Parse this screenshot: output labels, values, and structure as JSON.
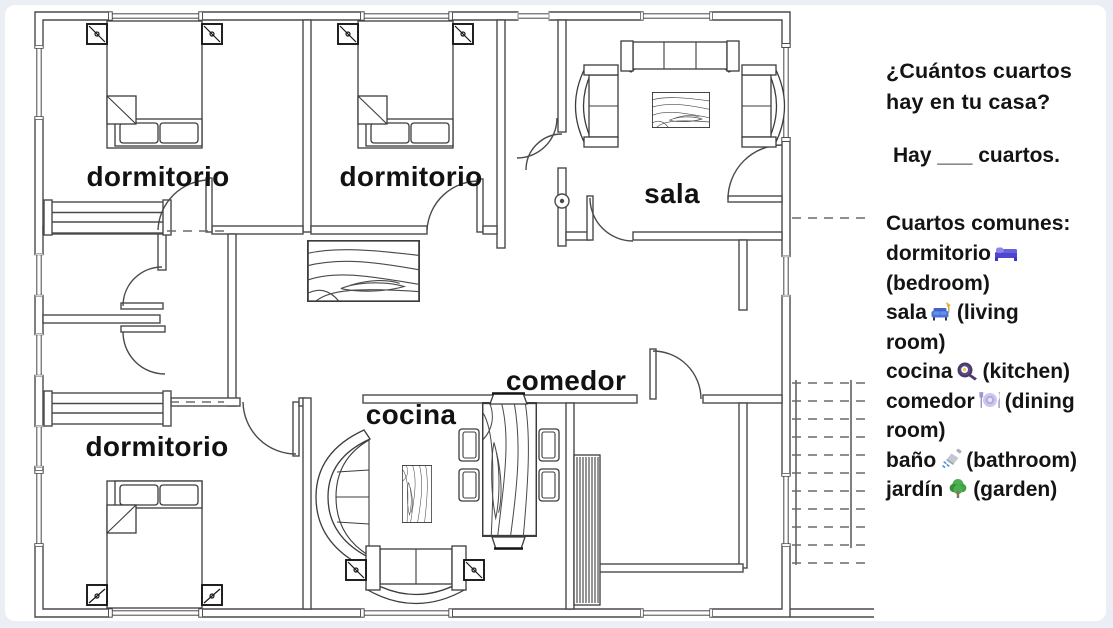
{
  "colors": {
    "wall": "#4a4a4a",
    "text": "#141414",
    "background": "#ffffff",
    "frame": "#eceef6",
    "icon_bed": "#4f46cf",
    "icon_couch": "#4a72d8",
    "icon_lamp": "#e8b23a",
    "icon_pan": "#4a3a6b",
    "icon_yolk": "#f7c948",
    "icon_plate": "#cdc6ee",
    "icon_shower": "#c3c7d4",
    "icon_drops": "#4a90d9",
    "icon_tree": "#4caf50",
    "icon_trunk": "#8d6e63"
  },
  "floorplan": {
    "room_labels": [
      {
        "id": "dormitorio-1",
        "text": "dormitorio"
      },
      {
        "id": "dormitorio-2",
        "text": "dormitorio"
      },
      {
        "id": "sala",
        "text": "sala"
      },
      {
        "id": "dormitorio-3",
        "text": "dormitorio"
      },
      {
        "id": "cocina",
        "text": "cocina"
      },
      {
        "id": "comedor",
        "text": "comedor"
      }
    ]
  },
  "panel": {
    "question": "¿Cuántos cuartos hay en tu casa?",
    "answer_prompt": "Hay ___ cuartos.",
    "vocab_heading": "Cuartos comunes:",
    "vocab": [
      {
        "es": "dormitorio",
        "icon": "bed-icon",
        "emoji": "🛏️",
        "en": "(bedroom)"
      },
      {
        "es": "sala",
        "icon": "couch-lamp-icon",
        "emoji": "🛋️",
        "en": "(living room)"
      },
      {
        "es": "cocina",
        "icon": "frying-pan-icon",
        "emoji": "🍳",
        "en": "(kitchen)"
      },
      {
        "es": "comedor",
        "icon": "plate-cutlery-icon",
        "emoji": "🍽️",
        "en": "(dining room)"
      },
      {
        "es": "baño",
        "icon": "shower-icon",
        "emoji": "🚿",
        "en": "(bathroom)"
      },
      {
        "es": "jardín",
        "icon": "tree-icon",
        "emoji": "🌳",
        "en": "(garden)"
      }
    ]
  }
}
